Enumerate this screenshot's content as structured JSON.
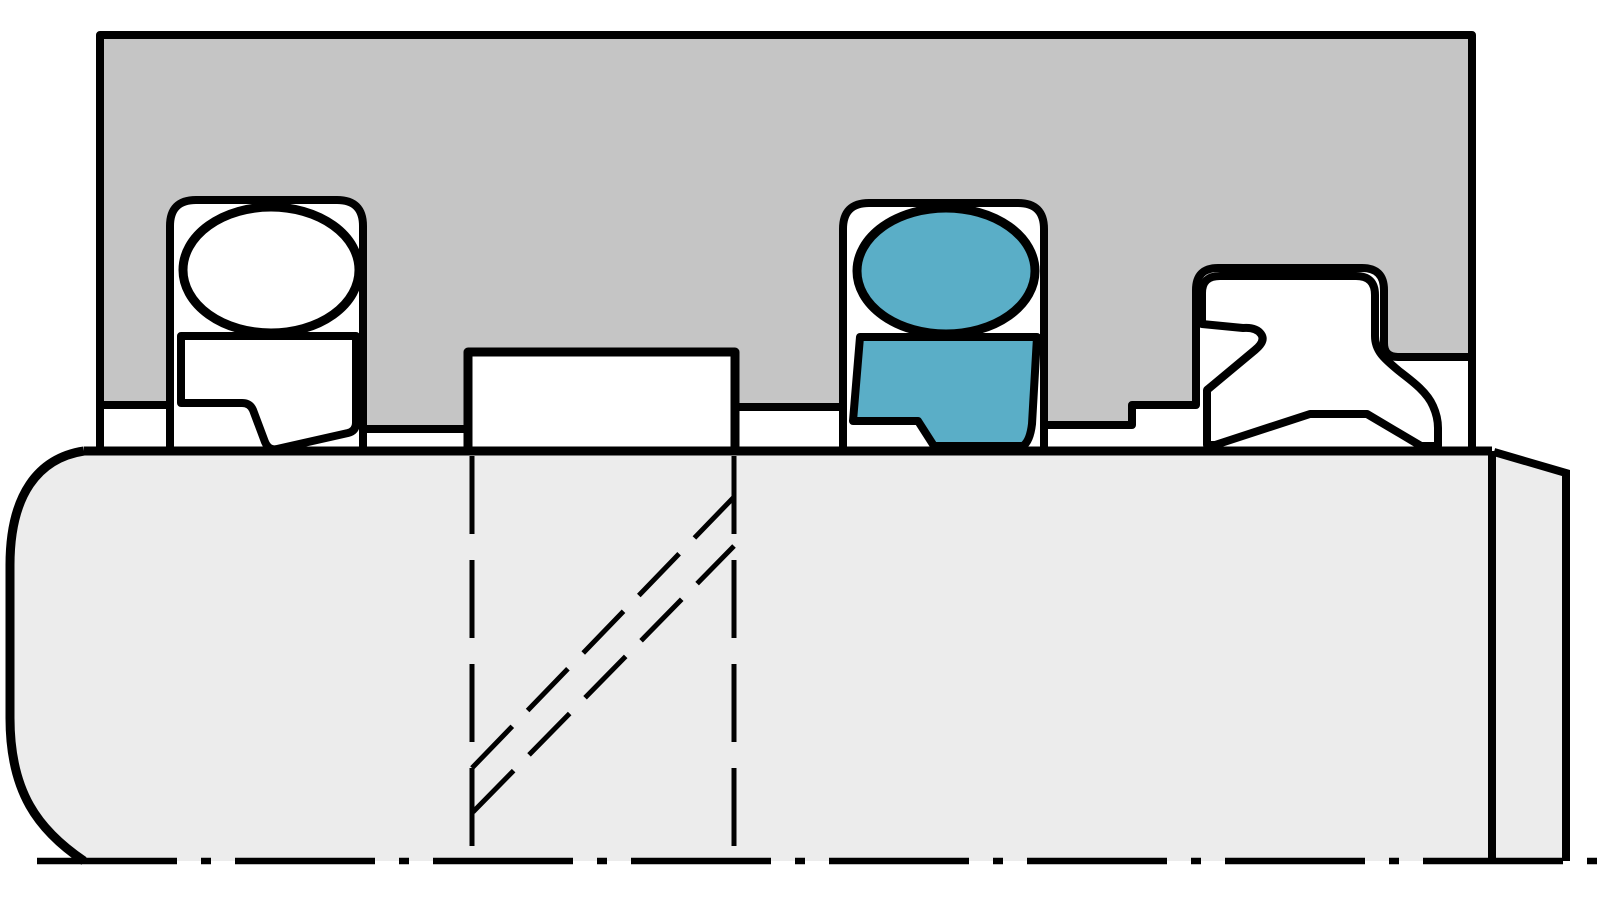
{
  "colors": {
    "background": "#ffffff",
    "housing_gray": "#c5c5c5",
    "shaft_gray": "#ececec",
    "seal_white": "#ffffff",
    "seal_teal": "#5aaec7",
    "outline_black": "#000000"
  },
  "parts": {
    "housing": "housing-with-three-seal-grooves",
    "shaft": "rod-shaft-half-section",
    "left_seal": "rod-seal-with-white-oring-energizer",
    "center_seal": "rod-seal-with-teal-oring-energizer",
    "right_seal": "wiper-scraper-seal",
    "block": "guide-ring-block",
    "break_lines": "hidden-break-dashed-lines",
    "centerline": "rod-axis-centerline"
  }
}
